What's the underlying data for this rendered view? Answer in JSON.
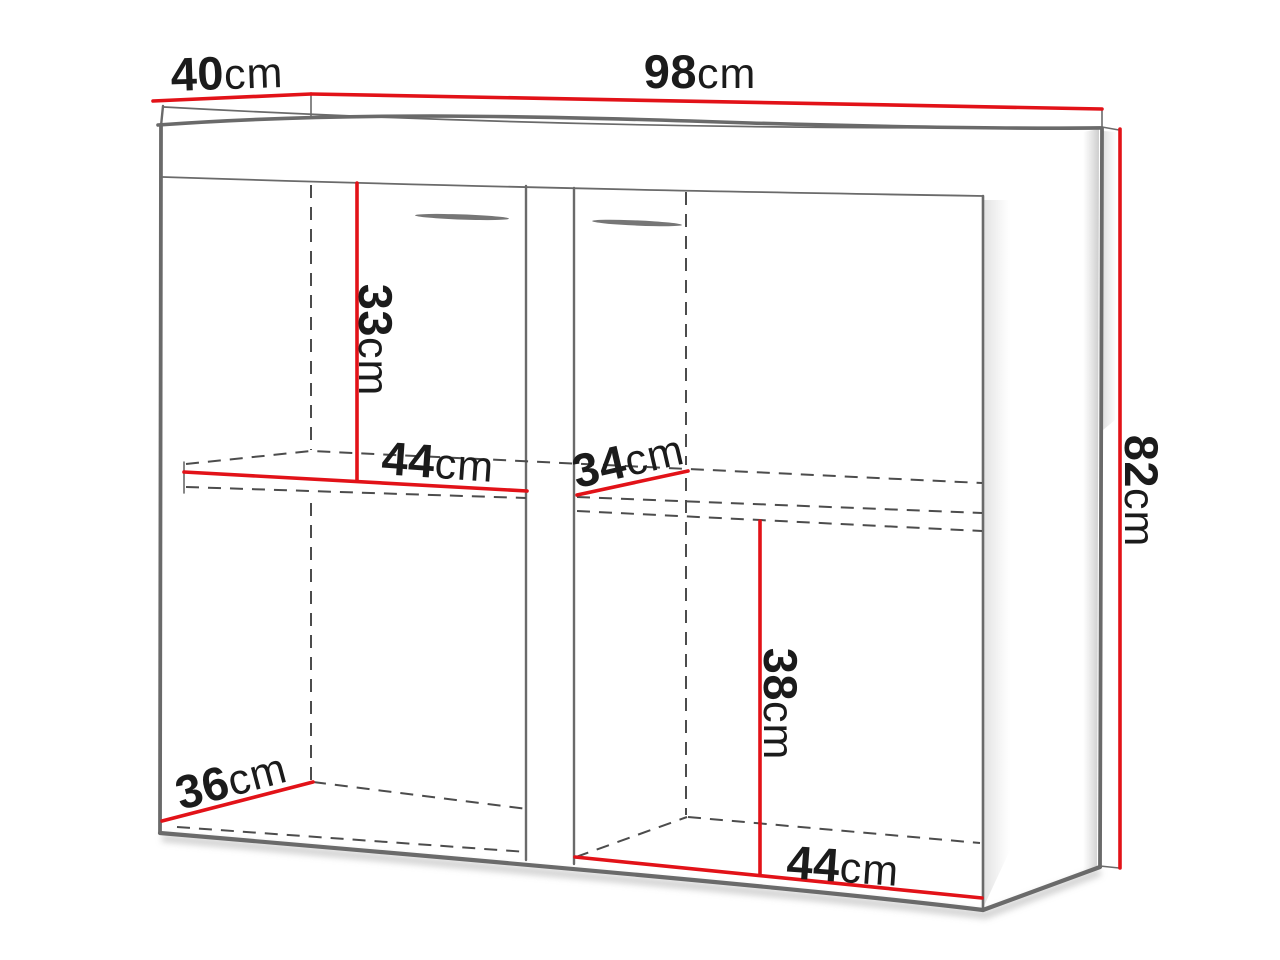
{
  "diagram": {
    "type": "furniture-dimension-diagram",
    "unit": "cm",
    "colors": {
      "dimension_line": "#e21218",
      "edge": "#6a6a6a",
      "hidden_edge": "#4c4c4c",
      "label_text": "#1b1b1b",
      "background": "#ffffff"
    },
    "dimensions": {
      "top_depth": {
        "value": "40",
        "unit": "cm"
      },
      "top_width": {
        "value": "98",
        "unit": "cm"
      },
      "right_height": {
        "value": "82",
        "unit": "cm"
      },
      "left_upper_height": {
        "value": "33",
        "unit": "cm"
      },
      "left_shelf_width": {
        "value": "44",
        "unit": "cm"
      },
      "right_shelf_depth": {
        "value": "34",
        "unit": "cm"
      },
      "right_lower_height": {
        "value": "38",
        "unit": "cm"
      },
      "right_bottom_width": {
        "value": "44",
        "unit": "cm"
      },
      "left_bottom_depth": {
        "value": "36",
        "unit": "cm"
      }
    }
  }
}
